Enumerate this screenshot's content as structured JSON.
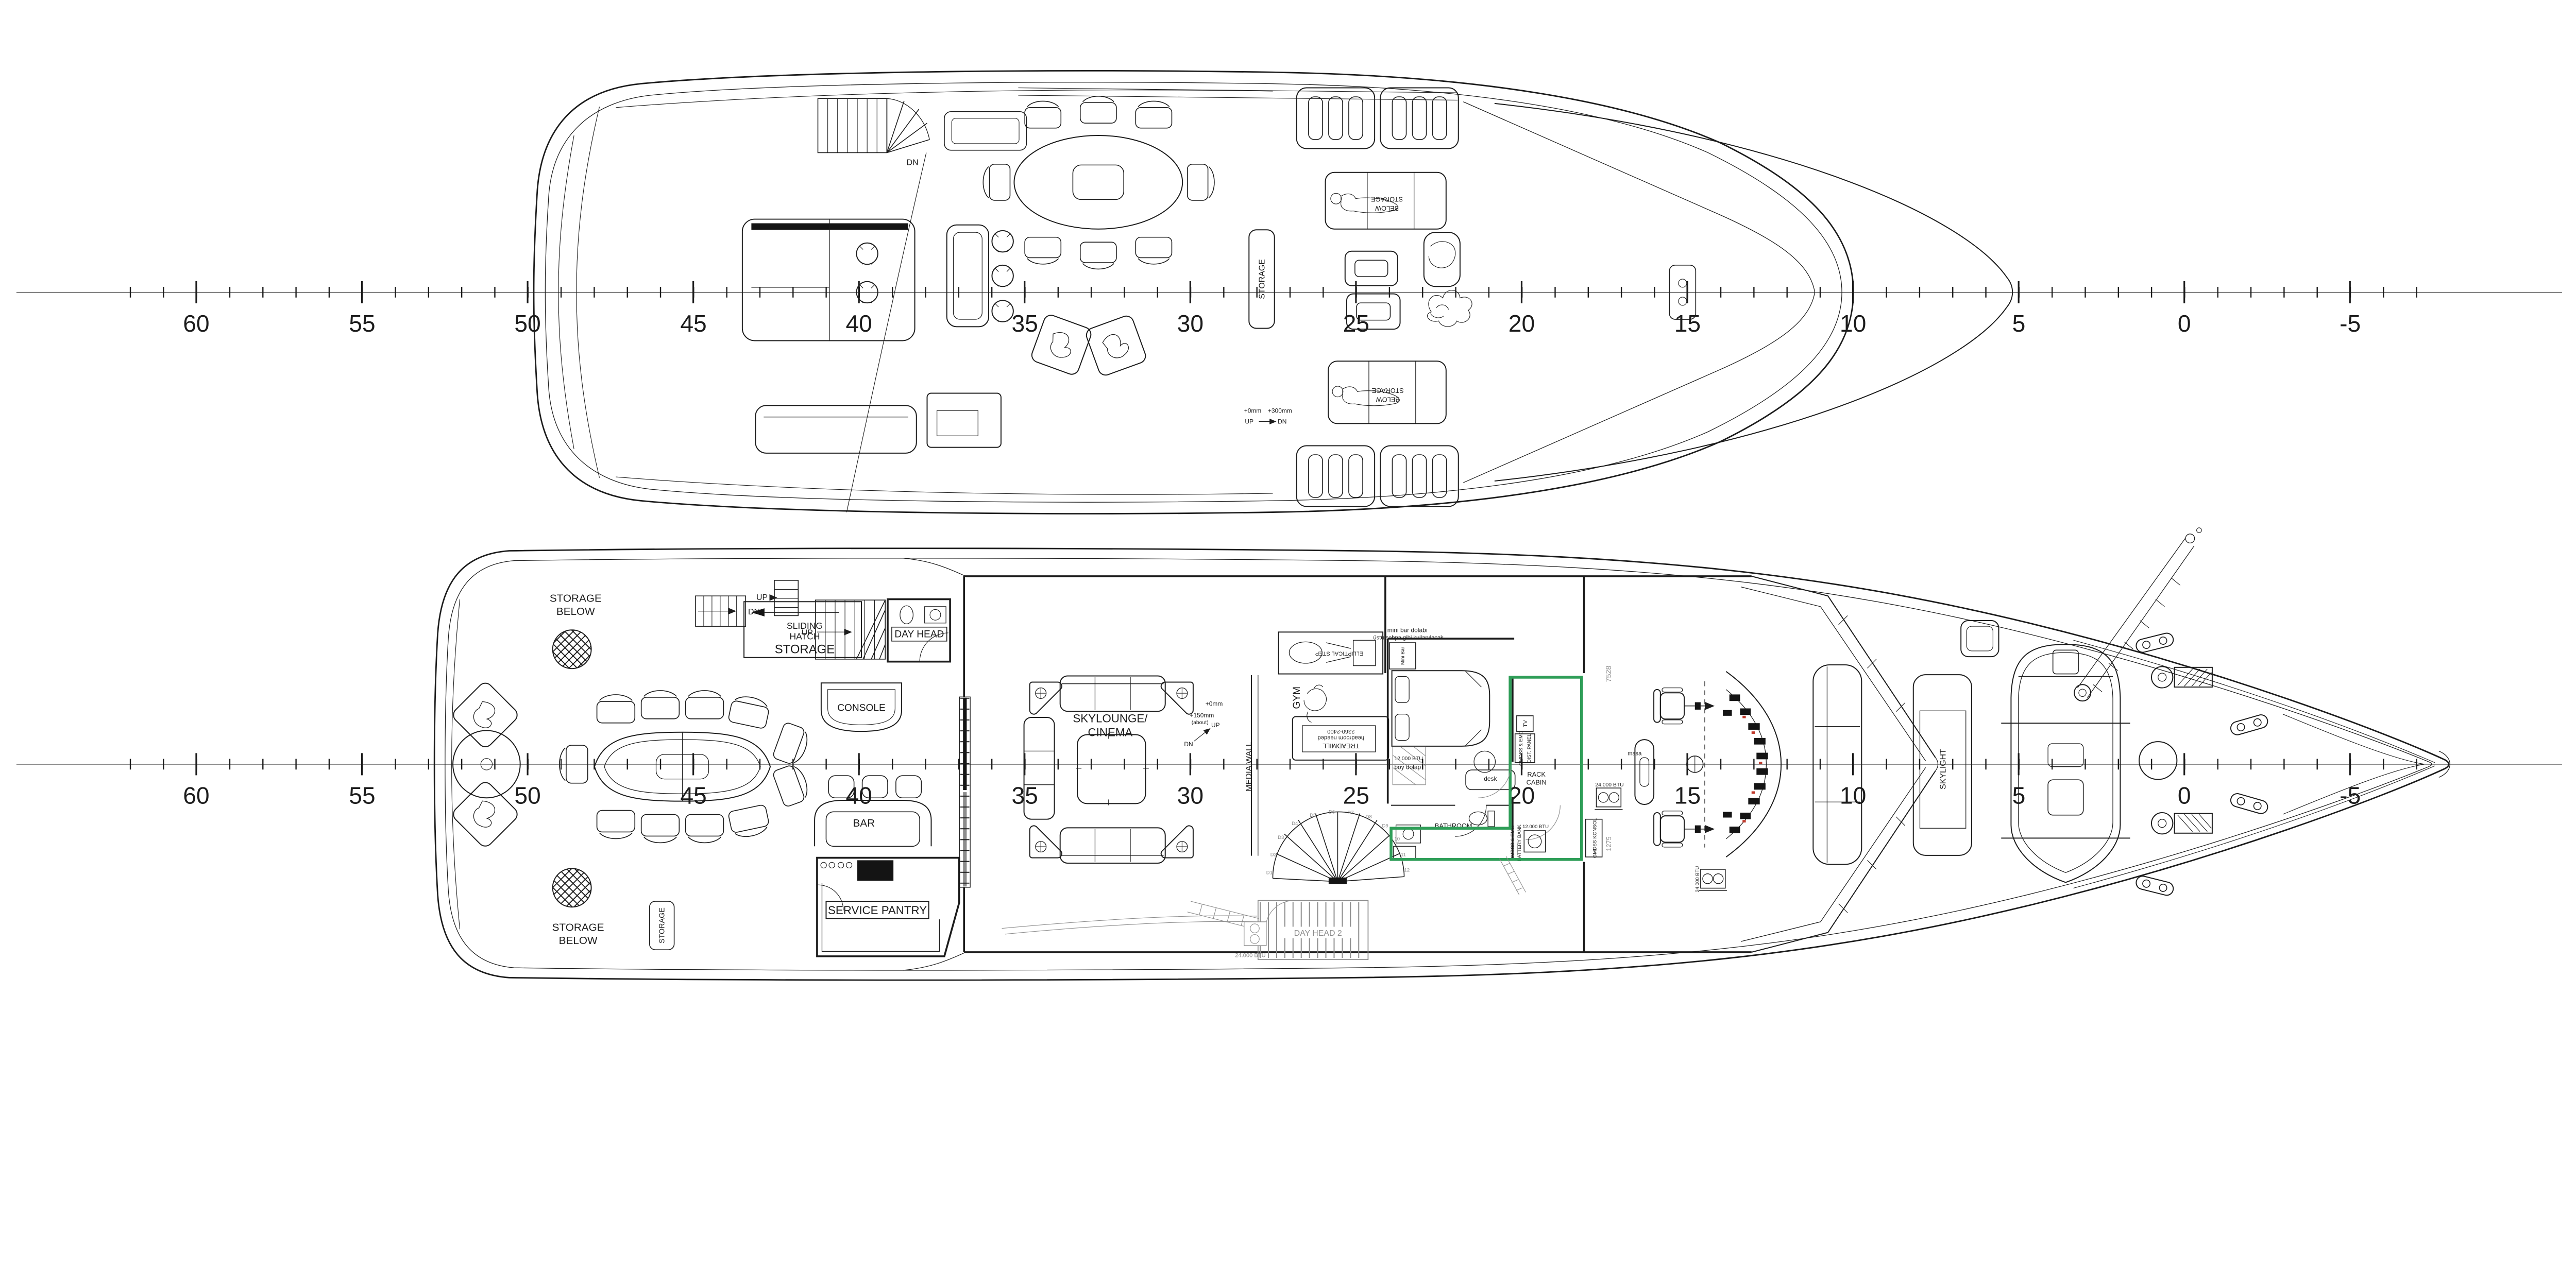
{
  "colors": {
    "line": "#1c1c1c",
    "below_deck_grey": "#8c8c8c",
    "modification_green": "#2f9e58",
    "instrument_red": "#c0392b",
    "paper": "#ffffff"
  },
  "rulers": {
    "station_labels": [
      "60",
      "55",
      "50",
      "45",
      "40",
      "35",
      "30",
      "25",
      "20",
      "15",
      "10",
      "5",
      "0",
      "-5"
    ]
  },
  "sun_deck": {
    "stair_dn": "DN",
    "storage_vertical": "STORAGE",
    "hatch_storage_line1": "STORAGE",
    "hatch_storage_line2": "BELOW",
    "step_note_zero": "+0mm",
    "step_note_high": "+300mm",
    "step_up": "UP",
    "step_dn": "DN"
  },
  "bridge_deck": {
    "storage_below_line1": "STORAGE",
    "storage_below_line2": "BELOW",
    "storage_vertical": "STORAGE",
    "sliding_hatch": [
      "SLIDING",
      "HATCH",
      "STORAGE"
    ],
    "stair_dn": "DN",
    "stair_up_side": "UP",
    "stair_up_inner": "UP",
    "day_head": "DAY HEAD",
    "console": "CONSOLE",
    "bar": "BAR",
    "service_pantry": "SERVICE PANTRY",
    "skylounge_line1": "SKYLOUNGE/",
    "skylounge_line2": "CINEMA",
    "step_note_zero": "+0mm",
    "step_note_high": "+150mm",
    "step_note_about": "(about)",
    "step_dn": "DN",
    "step_up": "UP",
    "media_wall": "MEDIA WALL",
    "gym": "GYM",
    "elliptical": "ELLIPTICAL STEP",
    "treadmill_line1": "TREADMILL",
    "treadmill_line2": "headroom needed",
    "treadmill_line3": "2360-2400",
    "minibar_note1": "mini bar dolabı",
    "minibar_note2": "üstü sehpa gibi kullanılacak",
    "minibar": "Mini Bar",
    "wardrobe": "boy dolap",
    "btu_12": "12.000 BTU",
    "btu_24": "24.000 BTU",
    "desk": "desk",
    "tv": "TV",
    "gmdss_dist_line1": "GMDSS & EMG",
    "gmdss_dist_line2": "DIST. PANEL",
    "rack_line1": "RACK",
    "rack_line2": "CABIN",
    "bathroom": "BATHROOM",
    "gmdss_batt_line1": "GMDSS & EMG",
    "gmdss_batt_line2": "BATTERY BANK",
    "gmdss_konsol": "GMDSS KONSOL",
    "masa": "masa",
    "skylight": "SKYLIGHT",
    "day_head_2": "DAY HEAD 2",
    "dim_7528": "7528",
    "dim_1275": "1275",
    "stair_steps": [
      "D1",
      "D2",
      "D3",
      "D4",
      "D5",
      "D6",
      "D7",
      "D8",
      "D9",
      "10",
      "11",
      "12"
    ]
  }
}
